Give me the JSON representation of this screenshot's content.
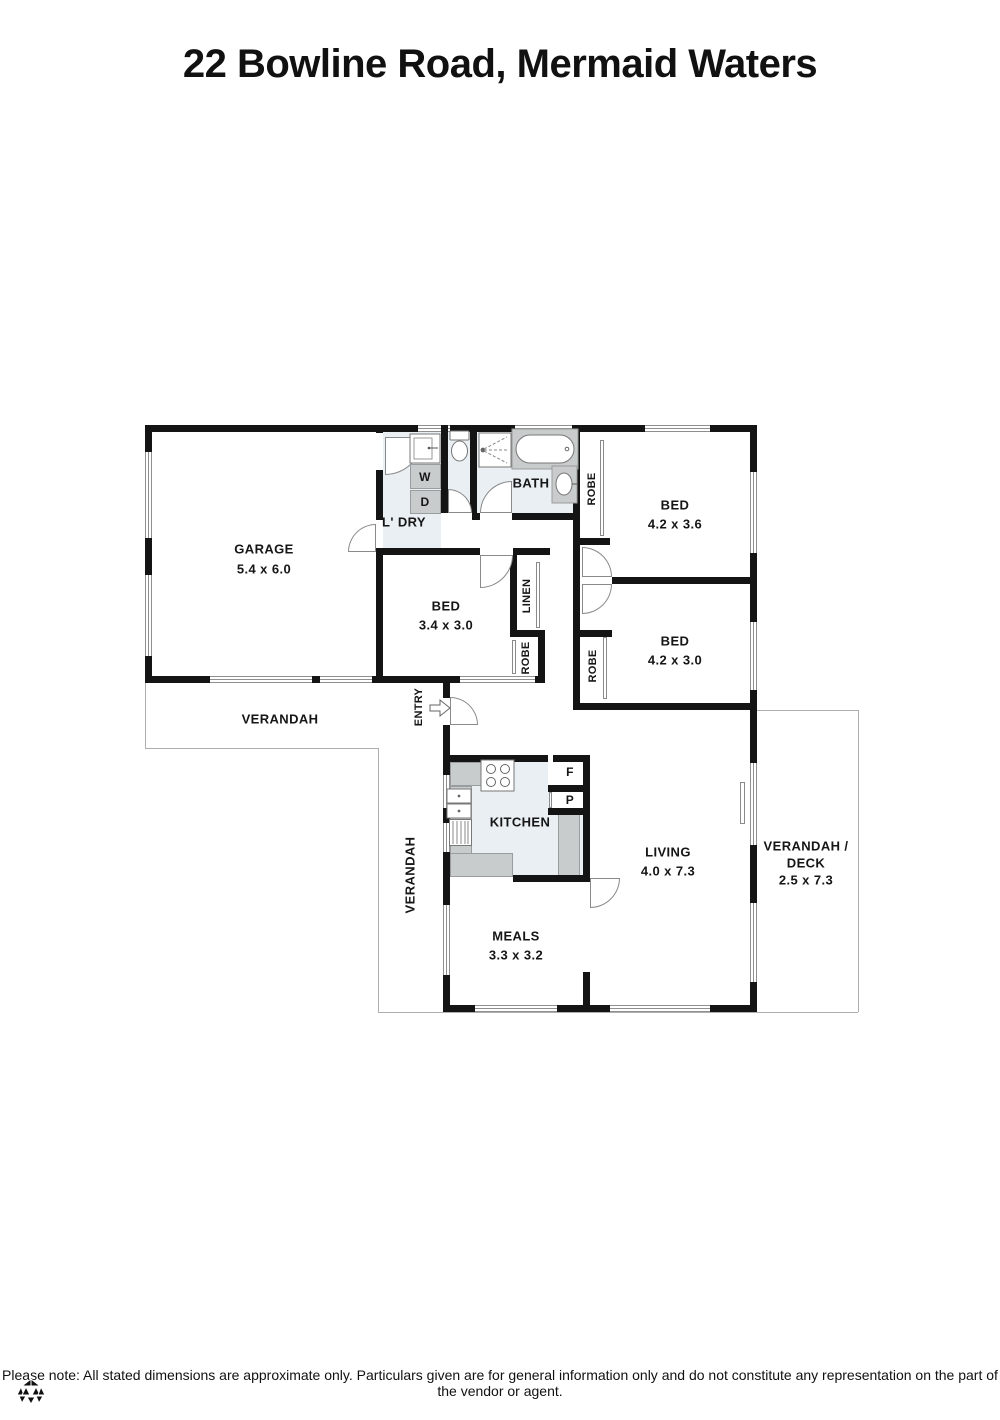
{
  "title": "22 Bowline Road, Mermaid Waters",
  "disclaimer": "Please note: All stated dimensions are approximate only. Particulars given are for general information only and do not constitute any representation on the part of the vendor or agent.",
  "labels": {
    "garage_name": "GARAGE",
    "garage_dims": "5.4 x 6.0",
    "laundry": "L' DRY",
    "bath": "BATH",
    "bed1_name": "BED",
    "bed1_dims": "4.2 x 3.6",
    "bed2_name": "BED",
    "bed2_dims": "3.4 x 3.0",
    "bed3_name": "BED",
    "bed3_dims": "4.2 x 3.0",
    "kitchen": "KITCHEN",
    "living_name": "LIVING",
    "living_dims": "4.0 x 7.3",
    "meals_name": "MEALS",
    "meals_dims": "3.3 x 3.2",
    "verandah_front": "VERANDAH",
    "verandah_side": "VERANDAH",
    "deck_line1": "VERANDAH /",
    "deck_line2": "DECK",
    "deck_dims": "2.5 x 7.3",
    "entry": "ENTRY",
    "robe": "ROBE",
    "linen": "LINEN",
    "washer": "W",
    "dryer": "D",
    "fridge": "F",
    "pantry": "P"
  },
  "colors": {
    "wall": "#141414",
    "wet": "#e9eff2",
    "counter": "#c9cccc",
    "outline": "#aeaeae"
  }
}
